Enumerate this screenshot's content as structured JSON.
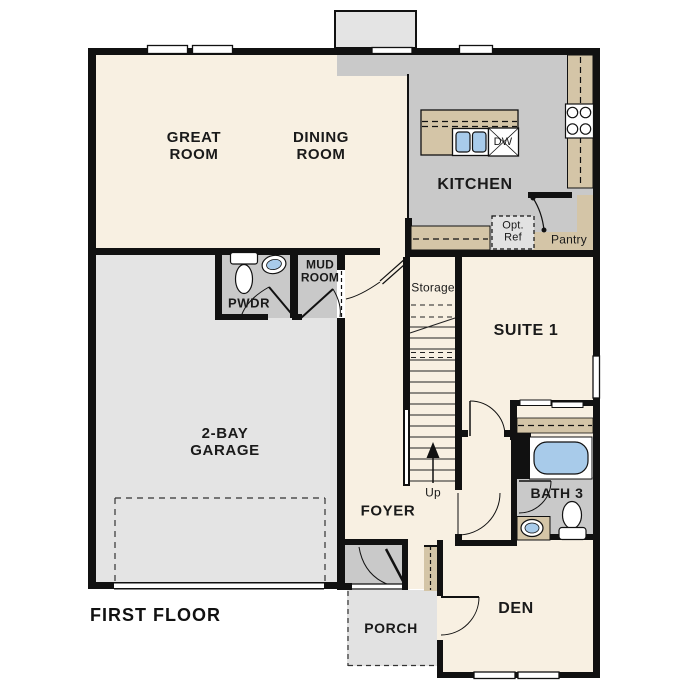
{
  "title": "FIRST FLOOR",
  "rooms": {
    "great": {
      "l1": "GREAT",
      "l2": "ROOM"
    },
    "dining": {
      "l1": "DINING",
      "l2": "ROOM"
    },
    "kitchen": {
      "label": "KITCHEN"
    },
    "pantry": {
      "label": "Pantry"
    },
    "opt_ref": {
      "l1": "Opt.",
      "l2": "Ref"
    },
    "dw": {
      "label": "DW"
    },
    "mud": {
      "l1": "MUD",
      "l2": "ROOM"
    },
    "pwdr": {
      "label": "PWDR"
    },
    "storage": {
      "label": "Storage"
    },
    "suite1": {
      "label": "SUITE 1"
    },
    "garage": {
      "l1": "2-BAY",
      "l2": "GARAGE"
    },
    "foyer": {
      "label": "FOYER"
    },
    "up": {
      "label": "Up"
    },
    "bath3": {
      "label": "BATH 3"
    },
    "den": {
      "label": "DEN"
    },
    "porch": {
      "label": "PORCH"
    }
  },
  "colors": {
    "room_cream": "#f8f0e2",
    "floor_gray": "#c9c9c9",
    "counter_tan": "#d4c5a7",
    "garage_gray": "#e4e4e4",
    "porch_gray": "#e2e2e2",
    "fixture_blue": "#a8cbea",
    "wall_black": "#111111"
  }
}
